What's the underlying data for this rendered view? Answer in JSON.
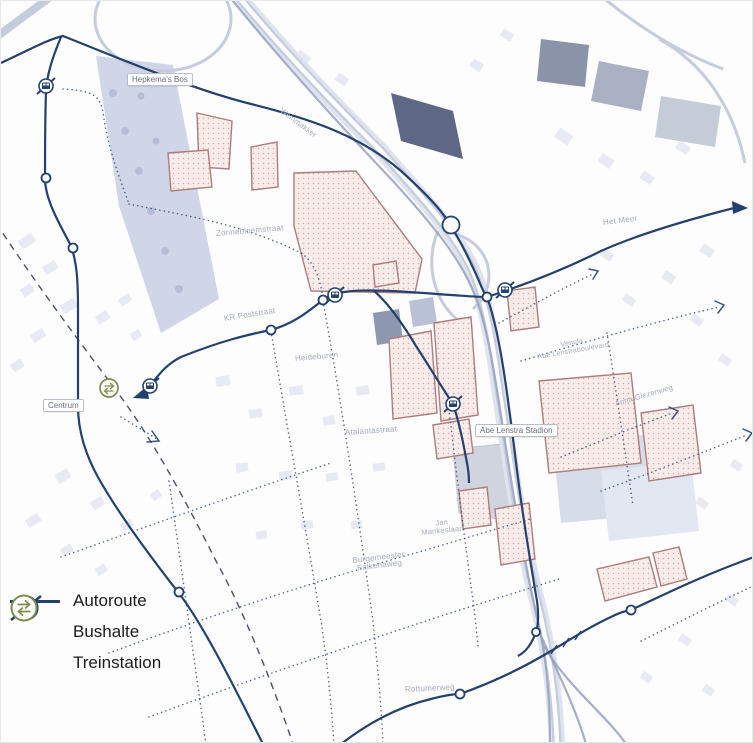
{
  "legend": {
    "items": [
      {
        "id": "autoroute",
        "label": "Autoroute",
        "icon": "route-line-icon"
      },
      {
        "id": "bushalte",
        "label": "Bushalte",
        "icon": "bus-stop-icon"
      },
      {
        "id": "treinstation",
        "label": "Treinstation",
        "icon": "train-station-icon"
      }
    ]
  },
  "map_labels": {
    "hepkemas_bos": "Hepkema's Bos",
    "weinmakker": "Weinmakker",
    "zonnebloemstraat": "Zonnebloemstraat",
    "het_meer": "Het Meer",
    "kr_poststraat": "KR Poststraat",
    "heideburen": "Heideburen",
    "centrum": "Centrum",
    "atalantastraat": "Atalantastraat",
    "abe_lenstra_stadion": "Abe Lenstra Stadion",
    "venela": "Venela",
    "abe_lenstraboulevard": "Abe Lenstraboulevard",
    "anna_giezenweg": "Anna Giezenweg",
    "jan": "Jan",
    "mankeslaan": "Mankeslaan",
    "burgemeester": "Burgemeester",
    "falkenaweg": "Falkenaweg",
    "rottumerweg": "Rottumerweg"
  },
  "colors": {
    "route": "#24406e",
    "rail_dash": "#4a5264",
    "highway": "#c5ccdc",
    "highway_light": "#dfe3ee",
    "rail_track": "#96a1bd",
    "dev_fill": "#f7ecea",
    "dev_stroke": "#ab7e7e",
    "building": "#e3e7f1",
    "building_mid": "#c9d0e2",
    "building_dark": "#4d5877",
    "label": "#a3a9b8",
    "train_icon": "#7e8c53",
    "legend_text": "#1c1c1c"
  }
}
